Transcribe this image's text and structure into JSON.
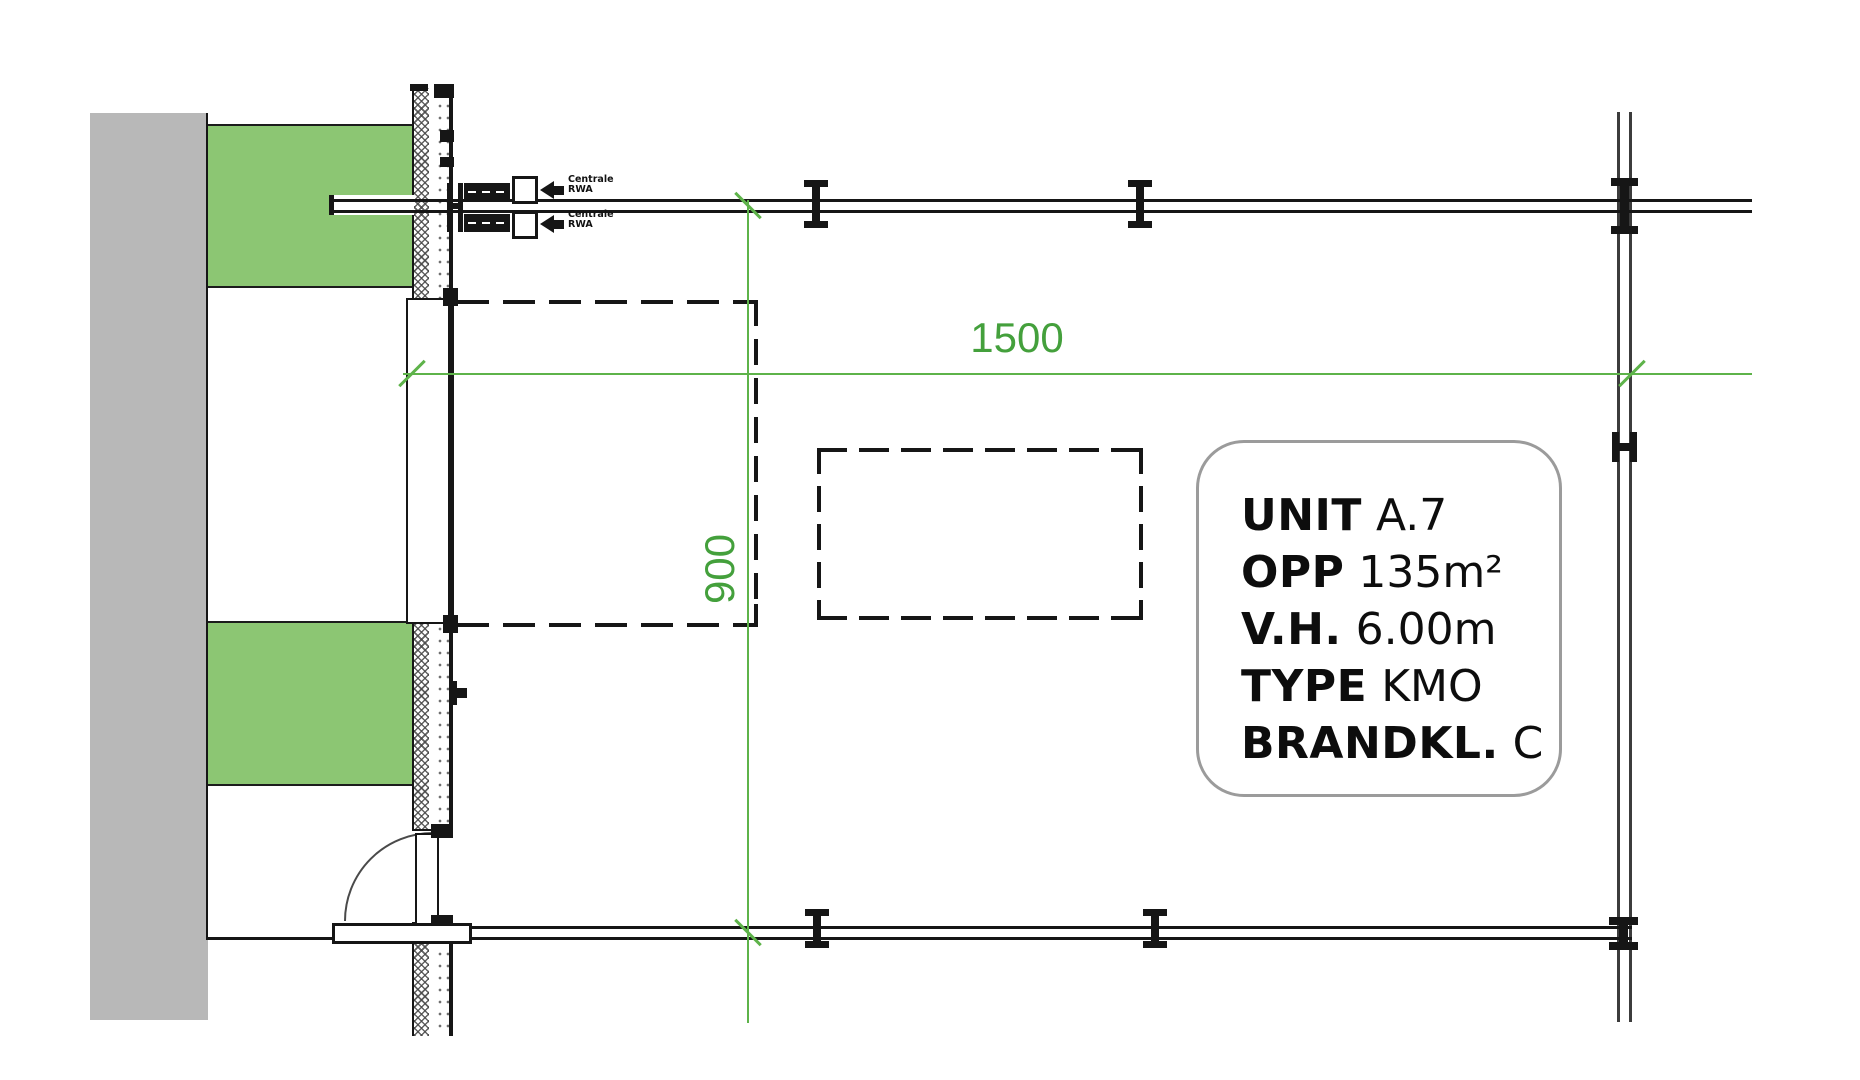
{
  "dimensions": {
    "horizontal": "1500",
    "vertical": "900"
  },
  "rwa_units": [
    {
      "line1": "Centrale",
      "line2": "RWA"
    },
    {
      "line1": "Centrale",
      "line2": "RWA"
    }
  ],
  "unit_info": {
    "rows": [
      {
        "label": "UNIT",
        "value": "A.7"
      },
      {
        "label": "OPP",
        "value": "135m²"
      },
      {
        "label": "V.H.",
        "value": "6.00m"
      },
      {
        "label": "TYPE",
        "value": "KMO"
      },
      {
        "label": "BRANDKL.",
        "value": "C"
      }
    ]
  },
  "colors": {
    "wall_gray": "#b8b8b8",
    "zone_green": "#8cc673",
    "dim_green": "#5eb34a",
    "text_green": "#44a03c",
    "ink": "#161616",
    "border_gray": "#9b9b9b"
  }
}
